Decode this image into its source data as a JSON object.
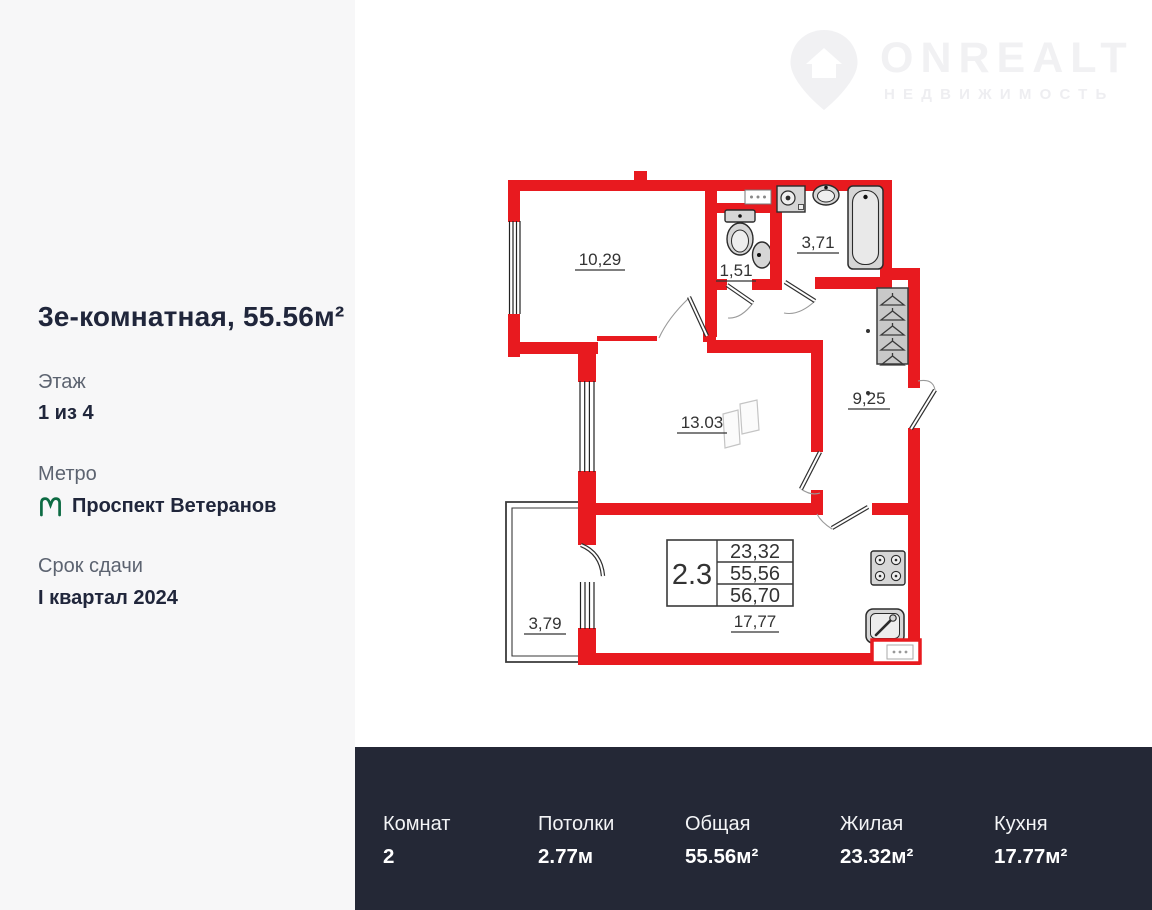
{
  "sidebar": {
    "title": "3е-комнатная, 55.56м²",
    "floor": {
      "label": "Этаж",
      "value": "1 из 4"
    },
    "metro": {
      "label": "Метро",
      "station": "Проспект Ветеранов"
    },
    "deadline": {
      "label": "Срок сдачи",
      "value": "I квартал 2024"
    }
  },
  "logo": {
    "brand": "ONREALT",
    "subtitle": "НЕДВИЖИМОСТЬ"
  },
  "plan": {
    "rooms": {
      "room1": "10,29",
      "wc": "1,51",
      "bathroom": "3,71",
      "room2": "13.03",
      "hallway": "9,25",
      "balcony": "3,79",
      "kitchen": "17,77"
    },
    "spec_table": {
      "apartment_type": "2.3",
      "rows": [
        "23,32",
        "55,56",
        "56,70"
      ]
    }
  },
  "stats": {
    "items": [
      {
        "label": "Комнат",
        "value": "2"
      },
      {
        "label": "Потолки",
        "value": "2.77м"
      },
      {
        "label": "Общая",
        "value": "55.56м²"
      },
      {
        "label": "Жилая",
        "value": "23.32м²"
      },
      {
        "label": "Кухня",
        "value": "17.77м²"
      }
    ]
  },
  "colors": {
    "wall_red": "#e81a1f",
    "bar_bg": "#242836",
    "sidebar_bg": "#f7f7f8",
    "metro_green": "#0d6b43",
    "text_dark": "#20263b",
    "text_gray": "#5c6370",
    "logo_gray": "#f1f1f3"
  }
}
